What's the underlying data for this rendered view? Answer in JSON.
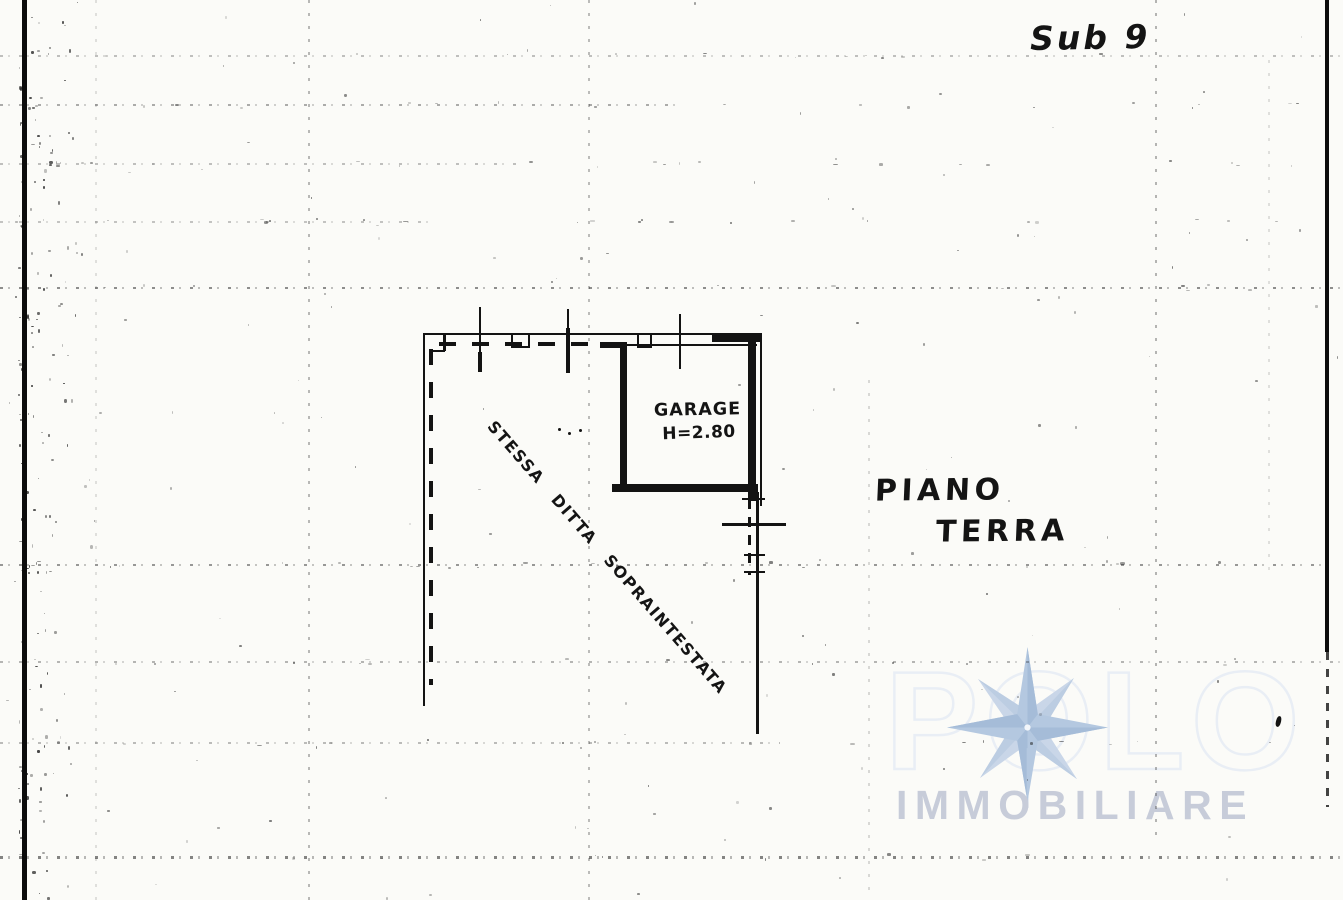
{
  "labels": {
    "sub": "Sub 9",
    "floor_line1": "PIANO",
    "floor_line2": "TERRA",
    "room": "GARAGE",
    "room_height": "H=2.80",
    "diagonal_note": "STESSA DITTA SOPRAINTESTATA"
  },
  "watermark": {
    "brand_faint": "POLO",
    "brand": "IMMOBILIARE",
    "star_icon": "compass-star-icon",
    "star_color": "#b4c8e0",
    "star_color_light": "#c9d6e8",
    "text_color": "#c7ccd9",
    "faint_outline_color": "#e9eef5"
  },
  "colors": {
    "ink": "#131313",
    "paper": "#fbfbf8",
    "grid": "#373737"
  }
}
